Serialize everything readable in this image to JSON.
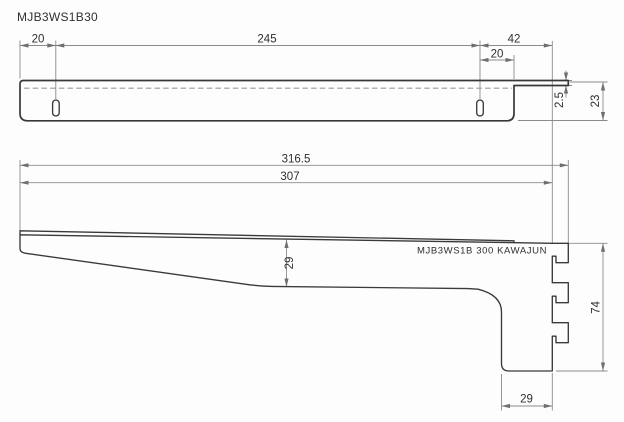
{
  "drawing": {
    "title": "MJB3WS1B30",
    "part_marking": "MJB3WS1B 300 KAWAJUN",
    "views": {
      "top_view": {
        "dims": {
          "edge_to_slot": "20",
          "slot_pitch": "245",
          "slot_to_hook_plate": "42",
          "slot_to_bar_end": "20",
          "plate_thickness": "2.5",
          "bar_width": "23"
        }
      },
      "side_view": {
        "dims": {
          "overall_length": "316.5",
          "length_to_plate": "307",
          "arm_height": "29",
          "plate_height": "74",
          "foot_depth": "29"
        }
      }
    },
    "colors": {
      "background": "#fdfdfd",
      "part_line": "#3a3a3a",
      "hidden_line": "#9a9a9a",
      "dimension_line": "#8b8b8b",
      "text": "#2f2f2f"
    }
  }
}
